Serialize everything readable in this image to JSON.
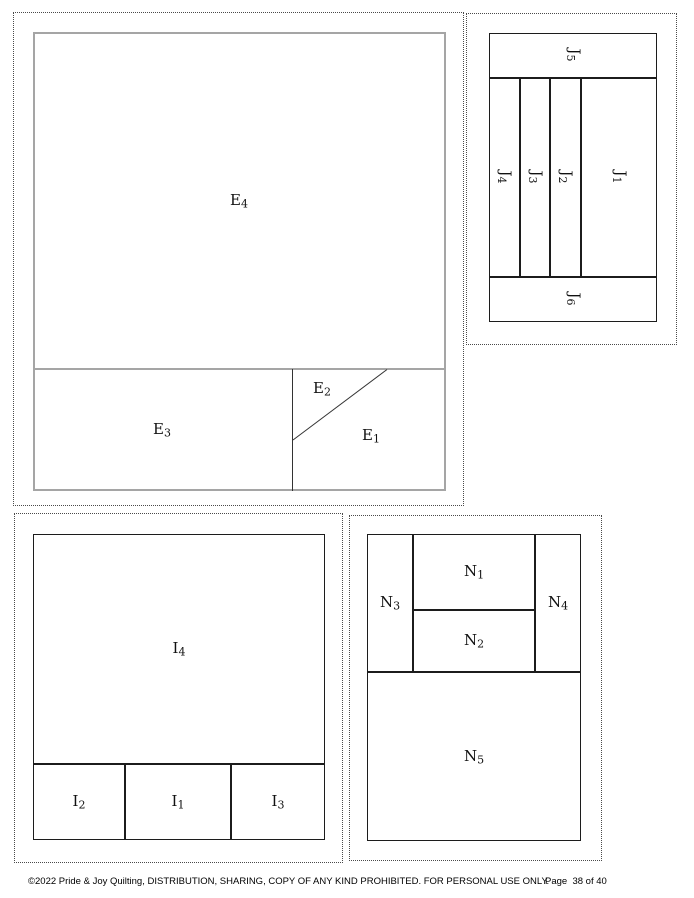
{
  "footer": {
    "copyright": "©2022 Pride & Joy Quilting, DISTRIBUTION, SHARING, COPY OF ANY KIND PROHIBITED. FOR PERSONAL USE ONLY.",
    "page_label": "Page  38 of 40"
  },
  "colors": {
    "template_outline_dark": "#1c1c1c",
    "template_outline_gray": "#a5a5a5",
    "seam_line": "#333333",
    "dotted_cut_border": "#4a4a4a",
    "label_text": "#111111"
  },
  "blocks": {
    "e": {
      "labels": {
        "e1": {
          "base": "E",
          "sub": "1"
        },
        "e2": {
          "base": "E",
          "sub": "2"
        },
        "e3": {
          "base": "E",
          "sub": "3"
        },
        "e4": {
          "base": "E",
          "sub": "4"
        }
      }
    },
    "j": {
      "labels": {
        "j1": {
          "base": "J",
          "sub": "1"
        },
        "j2": {
          "base": "J",
          "sub": "2"
        },
        "j3": {
          "base": "J",
          "sub": "3"
        },
        "j4": {
          "base": "J",
          "sub": "4"
        },
        "j5": {
          "base": "J",
          "sub": "5"
        },
        "j6": {
          "base": "J",
          "sub": "6"
        }
      }
    },
    "i": {
      "labels": {
        "i1": {
          "base": "I",
          "sub": "1"
        },
        "i2": {
          "base": "I",
          "sub": "2"
        },
        "i3": {
          "base": "I",
          "sub": "3"
        },
        "i4": {
          "base": "I",
          "sub": "4"
        }
      }
    },
    "n": {
      "labels": {
        "n1": {
          "base": "N",
          "sub": "1"
        },
        "n2": {
          "base": "N",
          "sub": "2"
        },
        "n3": {
          "base": "N",
          "sub": "3"
        },
        "n4": {
          "base": "N",
          "sub": "4"
        },
        "n5": {
          "base": "N",
          "sub": "5"
        }
      }
    }
  }
}
